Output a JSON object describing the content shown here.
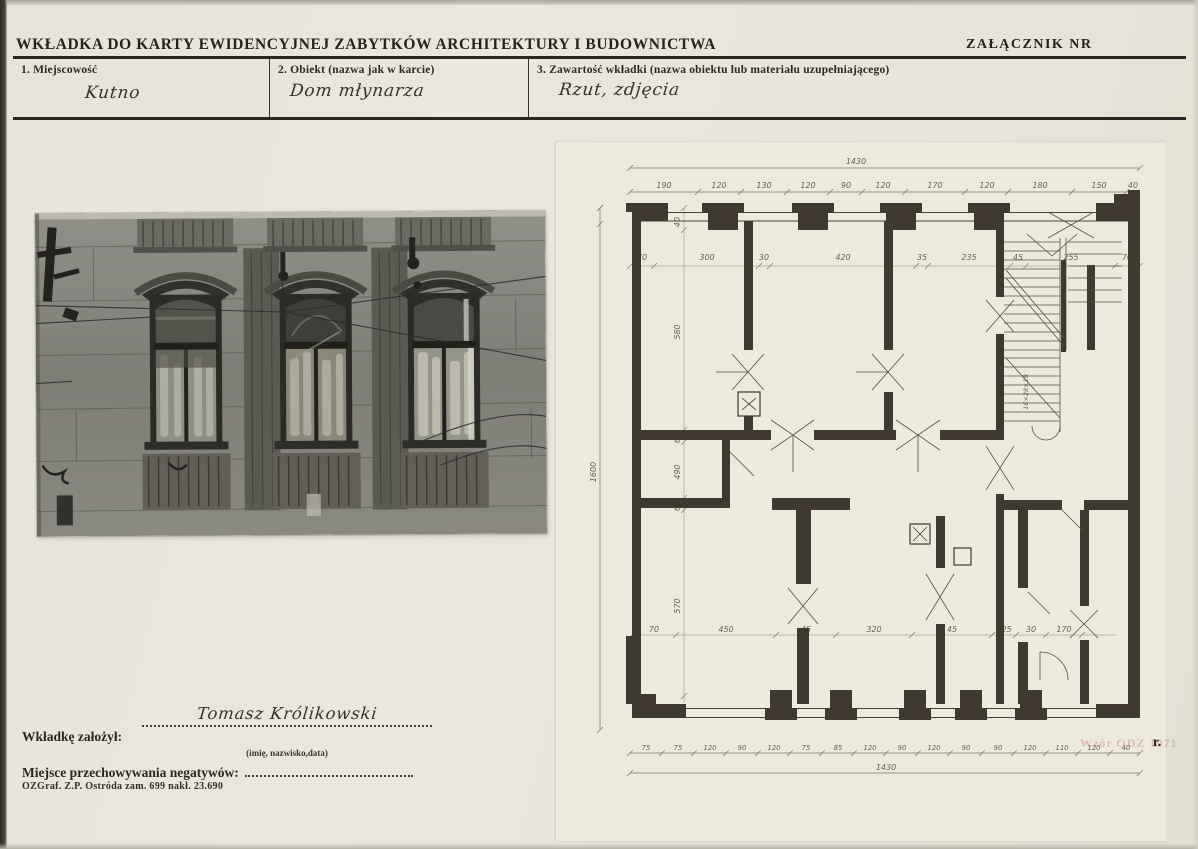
{
  "header": {
    "title": "WKŁADKA DO KARTY EWIDENCYJNEJ ZABYTKÓW ARCHITEKTURY I BUDOWNICTWA",
    "attachment": "ZAŁĄCZNIK NR"
  },
  "fields": {
    "locality": {
      "label": "1. Miejscowość",
      "value": "Kutno"
    },
    "object": {
      "label": "2. Obiekt (nazwa jak w karcie)",
      "value": "Dom młynarza"
    },
    "contents": {
      "label": "3. Zawartość wkładki (nazwa obiektu lub materiału uzupełniającego)",
      "value": "Rzut, zdjęcia"
    }
  },
  "photo": {
    "description": "Czarno-biała fotografia fasady kamienicy z trzema oknami"
  },
  "plan": {
    "description": "Odręczny rzut kondygnacji z wymiarami",
    "top_overall": "1430",
    "bottom_overall": "1430",
    "left_overall": "1600",
    "top_dims": [
      "190",
      "120",
      "130",
      "120",
      "90",
      "120",
      "170",
      "120",
      "180",
      "150",
      "40"
    ],
    "inner_top_dims": [
      "70",
      "300",
      "30",
      "420",
      "35",
      "235",
      "45",
      "255",
      "70"
    ],
    "left_dims": [
      "40",
      "580",
      "60",
      "490",
      "60",
      "570"
    ],
    "inner_bottom_dims": [
      "70",
      "450",
      "45",
      "320",
      "45",
      "225",
      "30",
      "170"
    ],
    "bottom_dims": [
      "75",
      "75",
      "120",
      "90",
      "120",
      "75",
      "85",
      "120",
      "90",
      "120",
      "90",
      "90",
      "120",
      "110",
      "120",
      "40"
    ],
    "stair_note": "16×28×18"
  },
  "footer": {
    "founder_label": "Wkładkę założył:",
    "founder_value": "Tomasz Królikowski",
    "founder_hint": "(imię, nazwisko,data)",
    "negatives_label": "Miejsce przechowywania negatywów:",
    "print_note": "OZGraf. Z.P. Ostróda zam. 699 nakł. 23.690",
    "stamp_faint": "Wzór ODZ 1971",
    "stamp_suffix": "r."
  }
}
